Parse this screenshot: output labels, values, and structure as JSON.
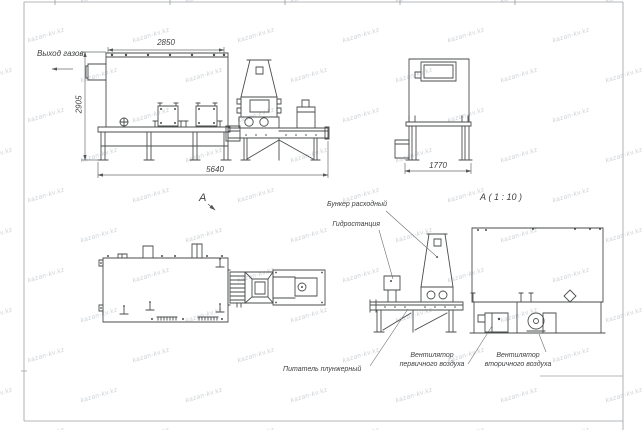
{
  "watermark": {
    "text": "kazan-kv.kz"
  },
  "colors": {
    "ink": "#4a4c4e",
    "thin": "#6b6d6f",
    "frame": "#9aa0a4",
    "watermark": "#cdd2d7"
  },
  "main_view": {
    "gas_outlet_label": "Выход газов",
    "dim_width_top": "2850",
    "dim_height_left": "2905",
    "dim_width_bottom": "5640"
  },
  "end_view": {
    "dim_width_bottom": "1770"
  },
  "plan_view": {
    "view_label": "А"
  },
  "detail_view": {
    "view_title": "А ( 1 : 10 )",
    "hopper_label": "Бункер расходный",
    "hydro_label": "Гидростанция",
    "feeder_label": "Питатель плунжерный",
    "fan_primary_line1": "Вентилятор",
    "fan_primary_line2": "первичного воздуха",
    "fan_secondary_line1": "Вентилятор",
    "fan_secondary_line2": "вторичного воздуха"
  }
}
